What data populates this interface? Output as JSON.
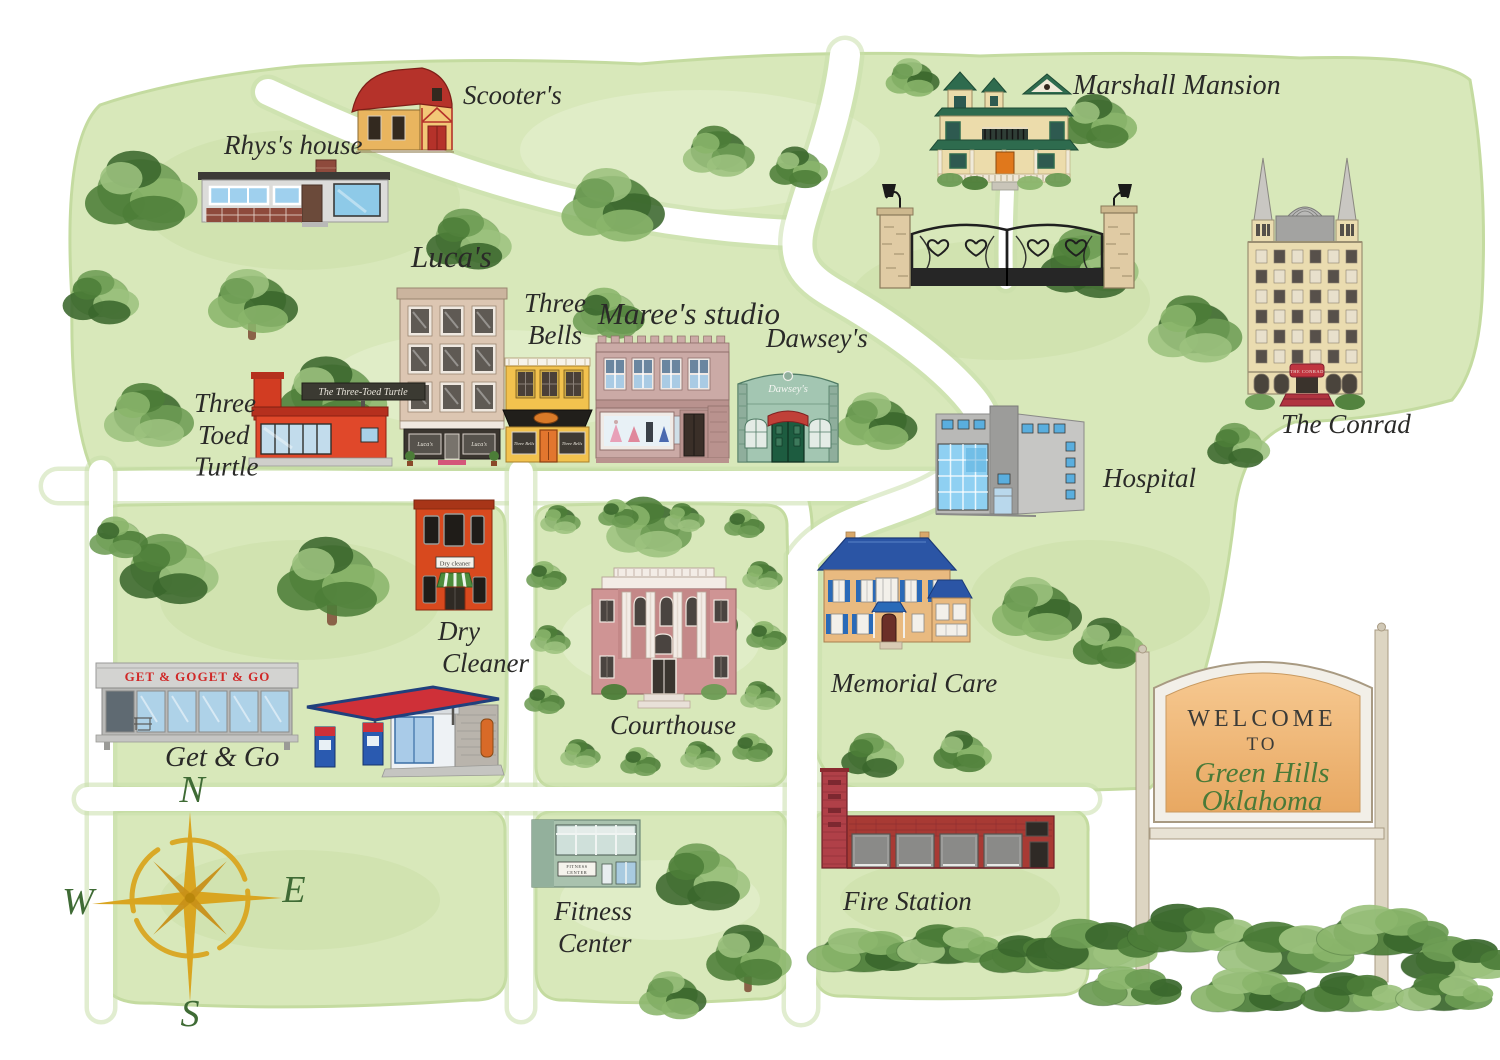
{
  "title": "Green Hills Oklahoma watercolor town map",
  "colors": {
    "background": "#ffffff",
    "wash": "#d8e8ba",
    "wash_dark": "#c4dba0",
    "wash_light": "#e7f1d3",
    "road": "#ffffff",
    "road_edge": "#c9dfa9",
    "label": "#2a2a28",
    "script_green": "#4a7a38",
    "gold": "#d9a520",
    "tree_greens": [
      "#6d9c54",
      "#4c7d38",
      "#8ab56b",
      "#3a672c",
      "#9cc27e"
    ],
    "trunk": "#8a6248"
  },
  "roads": [
    {
      "id": "main-street",
      "d": "M 58 486 H 940",
      "w": 30
    },
    {
      "id": "left-avenue",
      "d": "M 101 472 V 1008",
      "w": 24
    },
    {
      "id": "center-avenue",
      "d": "M 521 472 V 1008",
      "w": 24
    },
    {
      "id": "south-street",
      "d": "M 88 799 H 1086",
      "w": 24
    },
    {
      "id": "northwest-lane",
      "d": "M 268 92 C 430 168 600 225 793 233",
      "w": 26
    },
    {
      "id": "mansion-road",
      "d": "M 845 55 C 838 120 812 180 800 225 C 790 265 810 280 838 296 C 880 320 940 360 972 400 C 1000 435 980 465 940 488 C 900 512 830 520 803 560 L 801 1008",
      "w": 30
    },
    {
      "id": "mansion-driveway",
      "d": "M 1006 282 C 1005 250 1006 215 1007 192",
      "w": 14
    }
  ],
  "washes": [
    {
      "id": "north-region",
      "d": "M 72 300 Q 62 140 100 105 Q 180 78 300 66 Q 480 56 640 64 Q 820 48 980 56 Q 1150 50 1300 58 Q 1440 54 1470 80 Q 1488 180 1482 300 Q 1478 370 1452 400 Q 1380 420 1295 422 Q 1240 440 1234 520 Q 1222 620 1196 700 Q 1180 760 1150 788 Q 1000 794 880 790 Q 820 792 814 740 Q 810 640 812 540 Q 814 500 798 474 Q 600 468 400 470 Q 200 466 92 470 Q 70 420 72 300 Z"
    },
    {
      "id": "west-block",
      "d": "M 102 522 Q 100 504 128 505 Q 300 502 478 505 Q 506 503 505 528 Q 508 650 505 762 Q 506 789 478 787 Q 300 791 130 788 Q 101 790 102 764 Z"
    },
    {
      "id": "courthouse-block",
      "d": "M 536 522 Q 534 504 562 505 Q 660 502 760 505 Q 788 503 787 528 Q 790 650 787 762 Q 788 789 760 787 Q 660 791 564 788 Q 535 790 536 764 Z"
    },
    {
      "id": "southwest-block",
      "d": "M 104 828 Q 102 810 130 811 L 478 809 Q 506 808 505 832 L 506 972 Q 507 1002 470 1000 Q 300 1012 150 1003 Q 100 1005 102 968 Z"
    },
    {
      "id": "south-center-block",
      "d": "M 536 826 Q 534 810 562 811 L 760 809 Q 788 808 787 832 L 788 972 Q 789 1000 756 999 Q 660 1006 566 1000 Q 535 1002 536 968 Z"
    },
    {
      "id": "firestation-block",
      "d": "M 814 826 Q 812 810 840 811 L 1060 809 Q 1090 808 1088 832 L 1088 966 Q 1089 996 1056 995 Q 950 1002 844 996 Q 813 998 814 964 Z"
    }
  ],
  "mottles": [
    [
      300,
      200,
      160,
      70,
      "dark"
    ],
    [
      700,
      150,
      180,
      60,
      "light"
    ],
    [
      1000,
      300,
      150,
      60,
      "dark"
    ],
    [
      500,
      380,
      170,
      50,
      "light"
    ],
    [
      1090,
      600,
      120,
      60,
      "dark"
    ],
    [
      300,
      600,
      140,
      60,
      "dark"
    ],
    [
      660,
      640,
      100,
      50,
      "light"
    ],
    [
      300,
      900,
      140,
      50,
      "dark"
    ],
    [
      660,
      900,
      100,
      40,
      "light"
    ],
    [
      950,
      900,
      110,
      40,
      "dark"
    ]
  ],
  "trees": [
    [
      140,
      192,
      1.25,
      0,
      0
    ],
    [
      100,
      298,
      0.85,
      2,
      0
    ],
    [
      252,
      302,
      1.0,
      1,
      1
    ],
    [
      148,
      416,
      1.0,
      3,
      0
    ],
    [
      332,
      396,
      1.2,
      0,
      1
    ],
    [
      468,
      240,
      0.95,
      2,
      0
    ],
    [
      612,
      206,
      1.15,
      1,
      0
    ],
    [
      718,
      152,
      0.8,
      3,
      0
    ],
    [
      798,
      168,
      0.65,
      0,
      0
    ],
    [
      608,
      314,
      0.8,
      4,
      0
    ],
    [
      876,
      422,
      0.9,
      1,
      0
    ],
    [
      1088,
      264,
      1.1,
      2,
      0
    ],
    [
      1098,
      122,
      0.85,
      0,
      0
    ],
    [
      912,
      78,
      0.6,
      1,
      0
    ],
    [
      1194,
      330,
      1.05,
      3,
      0
    ],
    [
      1238,
      446,
      0.7,
      2,
      0
    ],
    [
      1036,
      610,
      1.0,
      1,
      0
    ],
    [
      1108,
      644,
      0.8,
      0,
      0
    ],
    [
      168,
      570,
      1.1,
      2,
      0
    ],
    [
      332,
      578,
      1.25,
      0,
      1
    ],
    [
      648,
      528,
      0.95,
      3,
      0
    ],
    [
      692,
      618,
      1.0,
      1,
      0
    ],
    [
      702,
      878,
      1.05,
      2,
      0
    ],
    [
      748,
      956,
      0.95,
      0,
      1
    ],
    [
      672,
      996,
      0.75,
      1,
      0
    ],
    [
      118,
      538,
      0.65,
      4,
      0
    ],
    [
      872,
      756,
      0.7,
      2,
      0
    ],
    [
      962,
      752,
      0.65,
      0,
      0
    ]
  ],
  "border_blobs": [
    [
      560,
      520
    ],
    [
      618,
      514
    ],
    [
      684,
      518
    ],
    [
      744,
      524
    ],
    [
      762,
      576
    ],
    [
      766,
      636
    ],
    [
      760,
      696
    ],
    [
      752,
      748
    ],
    [
      700,
      756
    ],
    [
      640,
      762
    ],
    [
      580,
      754
    ],
    [
      546,
      576
    ],
    [
      550,
      640
    ],
    [
      544,
      700
    ]
  ],
  "bushes": [
    [
      864,
      950,
      1.0,
      1
    ],
    [
      948,
      944,
      0.9,
      3
    ],
    [
      1028,
      954,
      0.85,
      0
    ],
    [
      1092,
      944,
      1.15,
      2
    ],
    [
      1190,
      928,
      1.1,
      0
    ],
    [
      1286,
      948,
      1.2,
      3
    ],
    [
      1382,
      930,
      1.15,
      1
    ],
    [
      1458,
      958,
      1.0,
      2
    ],
    [
      1130,
      986,
      0.9,
      4
    ],
    [
      1248,
      990,
      1.0,
      1
    ],
    [
      1352,
      992,
      0.9,
      0
    ],
    [
      1444,
      992,
      0.85,
      3
    ]
  ],
  "locations": [
    {
      "id": "scooters",
      "label": {
        "text": "Scooter's",
        "x": 463,
        "y": 104,
        "size": 27
      },
      "building": {
        "type": "barn",
        "x": 348,
        "y": 62,
        "colors": {
          "roof": "#b5322a",
          "body": "#e9b55f",
          "trim": "#b5322a"
        }
      }
    },
    {
      "id": "rhys-house",
      "label": {
        "text": "Rhys's house",
        "x": 224,
        "y": 154,
        "size": 27
      },
      "building": {
        "type": "ranch",
        "x": 198,
        "y": 160,
        "colors": {
          "body": "#dcdcda",
          "roof": "#3c3a36",
          "brick": "#8e4a3c",
          "window": "#9fd0ee"
        }
      }
    },
    {
      "id": "marshall-mansion",
      "label": {
        "text": "Marshall Mansion",
        "x": 1073,
        "y": 94,
        "size": 28
      },
      "building": {
        "type": "mansion",
        "x": 930,
        "y": 70,
        "colors": {
          "body": "#ecdcab",
          "roof": "#2e6b4e",
          "door": "#e0781c"
        }
      }
    },
    {
      "id": "estate-gate",
      "building": {
        "type": "gate",
        "x": 876,
        "y": 182,
        "colors": {
          "stone": "#e0cba4",
          "iron": "#1f1f1f"
        }
      }
    },
    {
      "id": "the-conrad",
      "label": {
        "text": "The Conrad",
        "x": 1281,
        "y": 433,
        "size": 27
      },
      "building": {
        "type": "hotel",
        "x": 1246,
        "y": 158,
        "colors": {
          "body": "#eadcb0",
          "roof": "#9a9a9a",
          "awning": "#c03540"
        },
        "sign": "THE CONRAD"
      }
    },
    {
      "id": "lucas",
      "label": {
        "text": "Luca's",
        "x": 411,
        "y": 267,
        "size": 31
      },
      "building": {
        "type": "lucas",
        "x": 400,
        "y": 288,
        "colors": {
          "body": "#dcc6b2",
          "storefront": "#3a352f",
          "mat": "#d4577a"
        },
        "window_text": "Luca's"
      }
    },
    {
      "id": "three-bells",
      "label": {
        "lines": [
          "Three",
          "Bells"
        ],
        "x": 524,
        "y": 312,
        "size": 27
      },
      "building": {
        "type": "bells",
        "x": 505,
        "y": 358,
        "colors": {
          "body": "#f2c24e",
          "awning": "#211f1b",
          "door": "#e2762e",
          "oval": "#d97a28"
        },
        "window_text": "Three Bells"
      }
    },
    {
      "id": "marees-studio",
      "label": {
        "text": "Maree's studio",
        "x": 598,
        "y": 324,
        "size": 31
      },
      "building": {
        "type": "marees",
        "x": 596,
        "y": 336,
        "colors": {
          "body": "#cbaaa6",
          "trim": "#b9928e",
          "window": "#a9cbe4",
          "display": "#e8f1f6"
        }
      }
    },
    {
      "id": "dawseys",
      "label": {
        "text": "Dawsey's",
        "x": 766,
        "y": 347,
        "size": 27
      },
      "building": {
        "type": "dawseys",
        "x": 736,
        "y": 354,
        "colors": {
          "body": "#a3c6b2",
          "door": "#1d5c40",
          "awning": "#c04038",
          "pilaster": "#8fae9c"
        },
        "sign": "Dawsey's"
      }
    },
    {
      "id": "three-toed-turtle",
      "label": {
        "lines": [
          "Three",
          "Toed",
          "Turtle"
        ],
        "x": 194,
        "y": 412,
        "size": 27
      },
      "building": {
        "type": "turtle",
        "x": 252,
        "y": 374,
        "colors": {
          "body": "#e0482a",
          "roof": "#b5301e",
          "window": "#c2dcec",
          "sign_bg": "#3b3a32"
        },
        "sign": "The Three-Toed Turtle"
      }
    },
    {
      "id": "hospital",
      "label": {
        "text": "Hospital",
        "x": 1103,
        "y": 487,
        "size": 27
      },
      "building": {
        "type": "hospital",
        "x": 936,
        "y": 402,
        "colors": {
          "body": "#b9b9b7",
          "tower": "#9c9c9a",
          "glass": "#8fd0f2"
        }
      }
    },
    {
      "id": "dry-cleaner",
      "label": {
        "lines": [
          "Dry",
          "Cleaner"
        ],
        "x": 438,
        "y": 640,
        "size": 27
      },
      "building": {
        "type": "drycleaner",
        "x": 416,
        "y": 500,
        "colors": {
          "body": "#d8491e",
          "awning": "#4e8c3c"
        },
        "sign": "Dry cleaner"
      }
    },
    {
      "id": "get-and-go",
      "label": {
        "text": "Get & Go",
        "x": 165,
        "y": 766,
        "size": 29
      },
      "building": {
        "type": "getgo",
        "x": 96,
        "y": 660,
        "colors": {
          "fascia": "#d3d3d1",
          "glass": "#aed2e8",
          "sign_color": "#d02828"
        },
        "sign": "GET & GO"
      }
    },
    {
      "id": "gas-station",
      "building": {
        "type": "gas",
        "x": 305,
        "y": 665,
        "colors": {
          "canopy": "#cf3038",
          "canopy_edge": "#20407d",
          "pump": "#2a5ab0",
          "kiosk": "#eef2f5"
        }
      }
    },
    {
      "id": "courthouse",
      "label": {
        "text": "Courthouse",
        "x": 610,
        "y": 734,
        "size": 27
      },
      "building": {
        "type": "courthouse",
        "x": 588,
        "y": 564,
        "colors": {
          "body": "#cf9494",
          "column": "#f3ece6"
        }
      }
    },
    {
      "id": "memorial-care",
      "label": {
        "text": "Memorial Care",
        "x": 831,
        "y": 692,
        "size": 27
      },
      "building": {
        "type": "memorial",
        "x": 814,
        "y": 530,
        "colors": {
          "body": "#e9ba80",
          "roof": "#2b55a5",
          "shutter": "#2a6ab8"
        }
      }
    },
    {
      "id": "fire-station",
      "label": {
        "text": "Fire Station",
        "x": 843,
        "y": 910,
        "size": 27
      },
      "building": {
        "type": "firestation",
        "x": 822,
        "y": 768,
        "colors": {
          "brick": "#a83a34",
          "tower": "#b04048",
          "bay": "#9c9c9a"
        }
      }
    },
    {
      "id": "fitness-center",
      "label": {
        "lines": [
          "Fitness",
          "Center"
        ],
        "x": 554,
        "y": 920,
        "size": 27
      },
      "building": {
        "type": "fitness",
        "x": 532,
        "y": 820,
        "colors": {
          "body": "#a9c2ae",
          "glass": "#cfe0da"
        },
        "sign_lines": [
          "FITNESS",
          "CENTER"
        ]
      }
    }
  ],
  "welcome_sign": {
    "x": 1128,
    "y": 616,
    "line1": "WELCOME",
    "line2": "TO",
    "line3": "Green Hills",
    "line4": "Oklahoma",
    "panel_top": "#f6c890",
    "panel_bottom": "#e8a862",
    "frame": "#f2efe8",
    "post": "#ddd5c2",
    "text_dark": "#3b3b38",
    "text_green": "#4a7a38"
  },
  "compass": {
    "cx": 190,
    "cy": 898,
    "n": "N",
    "s": "S",
    "e": "E",
    "w": "W",
    "gold": "#d9a520",
    "gold_dark": "#c89018",
    "letter": "#3f6b35"
  }
}
